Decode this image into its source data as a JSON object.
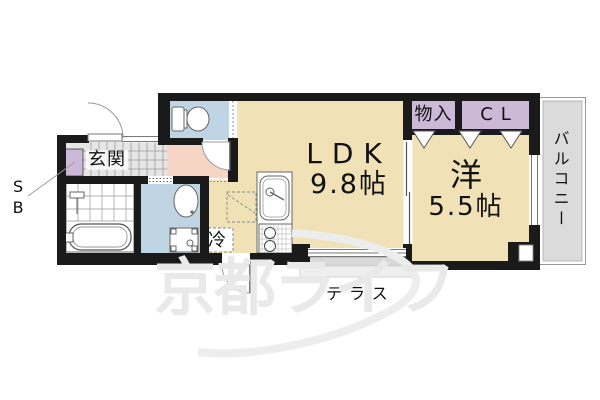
{
  "plan": {
    "rooms": {
      "ldk": {
        "name": "LDK",
        "size": "9.8帖"
      },
      "western": {
        "name": "洋",
        "size": "5.5帖"
      },
      "storage": {
        "name": "物入"
      },
      "closet": {
        "name": "CL"
      },
      "entrance": {
        "name": "玄関"
      },
      "balcony": {
        "name": "バルコニー"
      },
      "terrace": {
        "name": "テラス"
      },
      "shoe_box": {
        "name": "SB"
      },
      "refrigerator": {
        "name": "冷"
      }
    },
    "watermark": "京都ライフ",
    "colors": {
      "wall": "#1a1a1a",
      "room_floor": "#f0e2b6",
      "hallway_floor": "#f7d5c4",
      "wet_area_floor": "#c0d5e4",
      "storage_fill": "#ccb8d7",
      "balcony_fill": "#dbdbdb",
      "entrance_tile": "#e6e6e6",
      "terrace_fill": "#d9d9d9"
    }
  }
}
